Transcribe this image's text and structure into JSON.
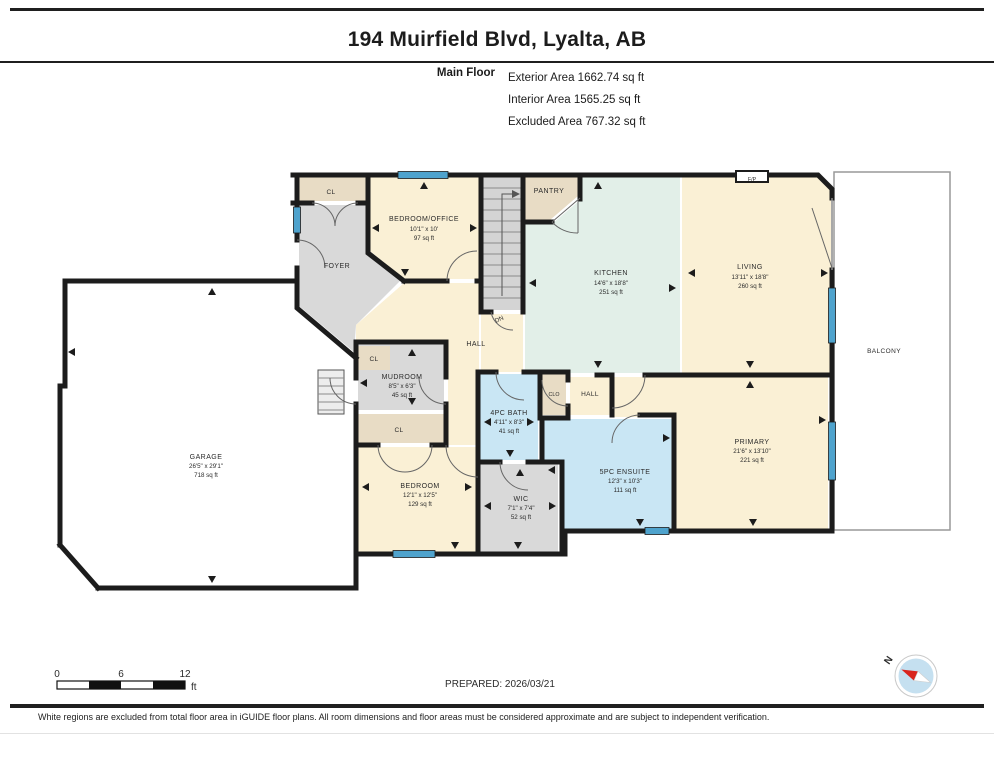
{
  "header": {
    "title": "194 Muirfield Blvd, Lyalta, AB",
    "floor_label": "Main Floor",
    "stats": [
      "Exterior Area 1662.74 sq ft",
      "Interior Area 1565.25 sq ft",
      "Excluded Area 767.32 sq ft"
    ]
  },
  "plan": {
    "rooms": {
      "cl_top": {
        "name": "CL"
      },
      "bedroom_office": {
        "name": "BEDROOM/OFFICE",
        "dims": "10'1\" x 10'",
        "area": "97 sq ft"
      },
      "pantry": {
        "name": "PANTRY"
      },
      "stairs": {
        "name": "DN"
      },
      "kitchen": {
        "name": "KITCHEN",
        "dims": "14'6\" x 18'8\"",
        "area": "251 sq ft"
      },
      "living": {
        "name": "LIVING",
        "dims": "13'11\" x 18'8\"",
        "area": "260 sq ft"
      },
      "fireplace": {
        "name": "F/P"
      },
      "foyer": {
        "name": "FOYER"
      },
      "hall": {
        "name": "HALL"
      },
      "mudroom": {
        "name": "MUDROOM",
        "dims": "8'5\" x 6'3\"",
        "area": "45 sq ft"
      },
      "cl_mud": {
        "name": "CL"
      },
      "cl_lower": {
        "name": "CL"
      },
      "bath": {
        "name": "4PC BATH",
        "dims": "4'11\" x 8'3\"",
        "area": "41 sq ft"
      },
      "clo": {
        "name": "CLO"
      },
      "hall2": {
        "name": "HALL"
      },
      "bedroom": {
        "name": "BEDROOM",
        "dims": "12'1\" x 12'5\"",
        "area": "129 sq ft"
      },
      "wic": {
        "name": "WIC",
        "dims": "7'1\" x 7'4\"",
        "area": "52 sq ft"
      },
      "ensuite": {
        "name": "5PC ENSUITE",
        "dims": "12'3\" x 10'3\"",
        "area": "111 sq ft"
      },
      "primary": {
        "name": "PRIMARY",
        "dims": "21'6\" x 13'10\"",
        "area": "221 sq ft"
      },
      "garage": {
        "name": "GARAGE",
        "dims": "26'5\" x 29'1\"",
        "area": "718 sq ft"
      },
      "balcony": {
        "name": "BALCONY"
      }
    },
    "colors": {
      "wall": "#1c1c1c",
      "window": "#4fa3cd",
      "room_cream": "#faf0d5",
      "room_teal": "#e2efe8",
      "room_gray": "#d9d9d9",
      "room_tan": "#e8dcc5",
      "room_blue": "#c9e6f4"
    }
  },
  "footer": {
    "scale": {
      "zero": "0",
      "six": "6",
      "twelve": "12",
      "unit": "ft"
    },
    "prepared": "PREPARED: 2026/03/21",
    "compass_n": "N"
  },
  "disclaimer": "White regions are excluded from total floor area in iGUIDE floor plans. All room dimensions and floor areas must be considered approximate and are subject to independent verification."
}
